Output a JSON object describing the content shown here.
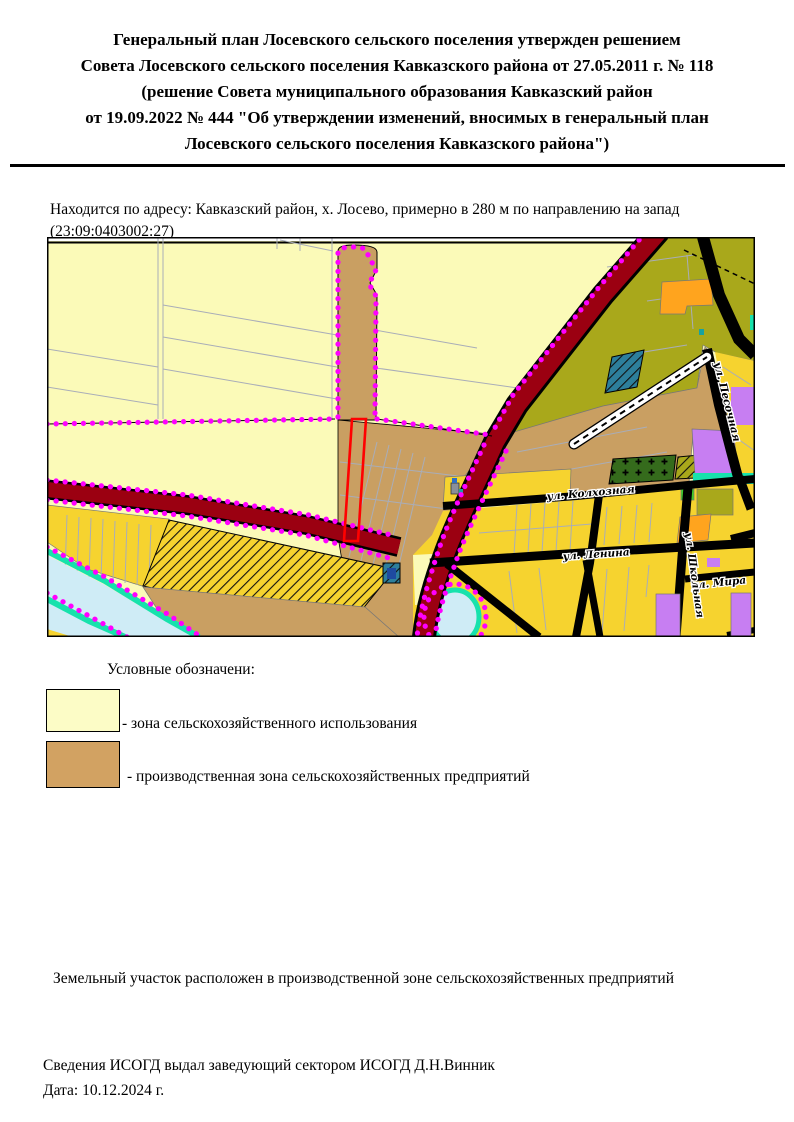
{
  "document": {
    "title_lines": [
      "Генеральный план Лосевского сельского поселения утвержден решением",
      "Совета Лосевского сельского поселения Кавказского района от 27.05.2011 г. № 118",
      "(решение Совета муниципального образования Кавказский район",
      "от 19.09.2022 № 444 \"Об утверждении изменений, вносимых в генеральный план",
      "Лосевского сельского поселения Кавказского района\")"
    ],
    "address": "Находится по адресу: Кавказский район, х. Лосево, примерно в 280 м по направлению на запад (23:09:0403002:27)",
    "zone_note": "Земельный участок расположен в производственной зоне сельскохозяйственных предприятий",
    "issued_by": "Сведения ИСОГД выдал заведующий сектором ИСОГД Д.Н.Винник",
    "date": "Дата: 10.12.2024 г."
  },
  "map": {
    "streets": [
      {
        "label": "ул. Колхозная"
      },
      {
        "label": "ул. Ленина"
      },
      {
        "label": "ул. Мира"
      },
      {
        "label": "ул. Школьная"
      },
      {
        "label": "ул. Песочная"
      }
    ],
    "colors": {
      "agricultural": "#FBFAB8",
      "production": "#C99F62",
      "residential": "#F6D32F",
      "greenery": "#A9A81B",
      "main_road": "#9B0011",
      "boundary_dots": "#FF00FF",
      "water": "#CFECF6",
      "water_edge": "#17E2AC",
      "special_purple": "#C77EF2",
      "special_orange": "#FFA41E"
    }
  },
  "legend": {
    "heading": "Условные обозначени:",
    "items": [
      {
        "label": "- зона сельскохозяйственного использования",
        "color": "#FCFCC6"
      },
      {
        "label": "- производственная зона сельскохозяйственных предприятий",
        "color": "#D2A262"
      }
    ]
  }
}
